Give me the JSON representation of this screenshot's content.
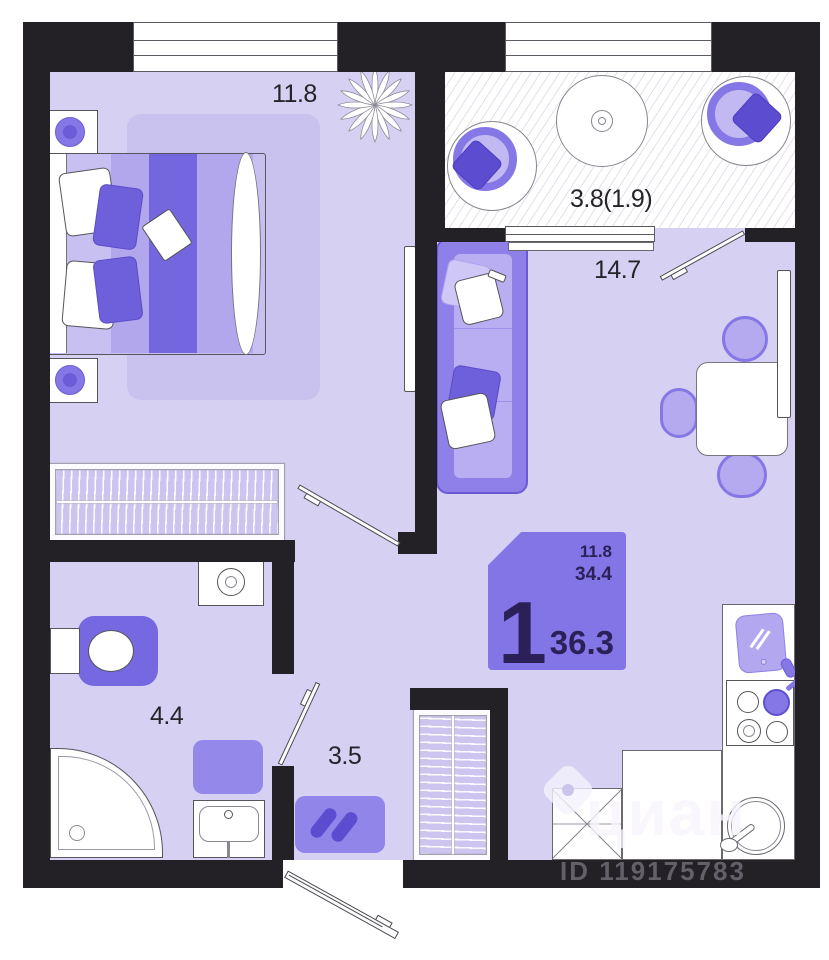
{
  "page": {
    "type": "apartment-floor-plan",
    "background": "#ffffff"
  },
  "rooms": {
    "bedroom": {
      "name": "bedroom",
      "area": "11.8"
    },
    "balcony": {
      "name": "balcony",
      "area": "3.8(1.9)"
    },
    "living_kitchen": {
      "name": "living-kitchen",
      "area": "14.7"
    },
    "bathroom": {
      "name": "bathroom",
      "area": "4.4"
    },
    "hallway": {
      "name": "hallway",
      "area": "3.5"
    }
  },
  "stamp": {
    "rooms_count": "1",
    "top_value": "11.8",
    "middle_value": "34.4",
    "total_area": "36.3",
    "bg_color": "#8375e6",
    "text_color": "#2b2158"
  },
  "watermark": {
    "brand": "циан",
    "listing_id": "ID 119175783"
  },
  "palette": {
    "wall": "#232026",
    "floor": "#d6d0f3",
    "rug": "#c9c1ee",
    "furniture_purple": "#8577e6",
    "furniture_dark_purple": "#6e5fda",
    "furniture_light": "#b9aef1",
    "outline": "#55555a"
  },
  "icons": [
    "double-bed",
    "bedside-lamp",
    "wardrobe-hangers",
    "plant",
    "tv-panel",
    "sofa-with-pillows",
    "dining-table",
    "chair",
    "balcony-armchair",
    "round-table",
    "toilet",
    "washing-machine",
    "corner-shower",
    "bath-mat",
    "washbasin",
    "shoe-rug",
    "hallway-closet",
    "kitchen-counter",
    "asterisk-cabinet",
    "round-sink",
    "stove-burners",
    "cutting-board",
    "door-leaf",
    "window"
  ]
}
